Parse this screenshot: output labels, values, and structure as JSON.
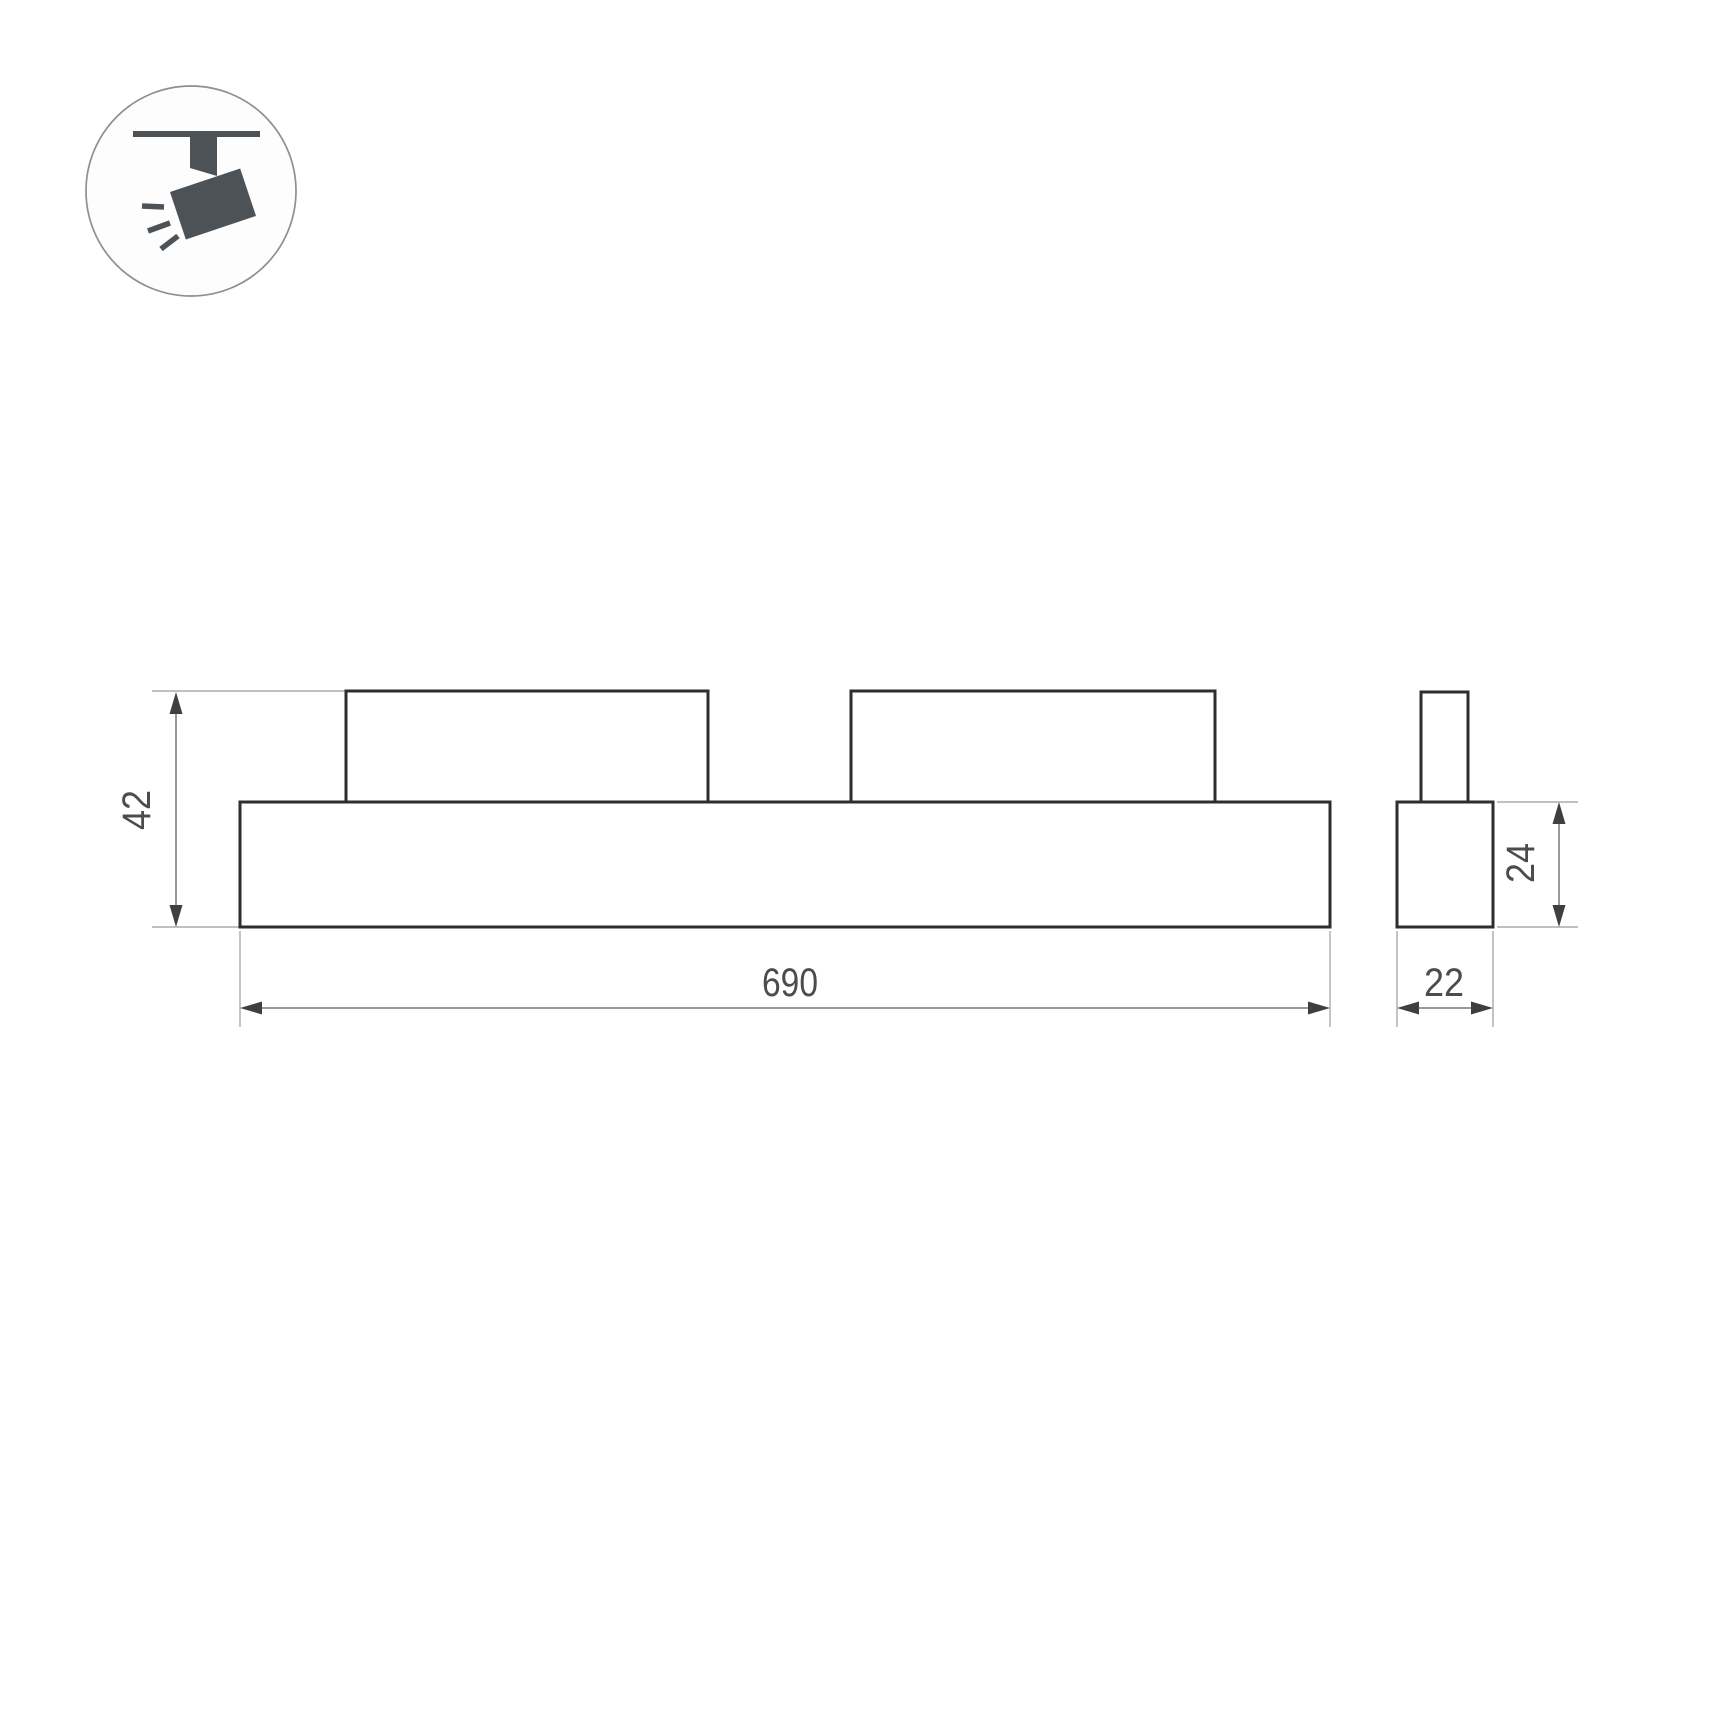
{
  "drawing": {
    "title": "track-mounted linear luminaire dimension drawing",
    "views": {
      "front": "front view with two top mounting modules",
      "side": "side profile with top connector stem"
    }
  },
  "dimensions": {
    "total_height": "42",
    "length": "690",
    "side_height": "24",
    "side_width": "22"
  },
  "icon": {
    "name": "track-spotlight-icon",
    "meaning": "ceiling track with tilted spotlight emitting light"
  },
  "colors": {
    "bg": "#ffffff",
    "outline": "#2c2e30",
    "thin": "#a9abad",
    "dim": "#77797b",
    "arrow": "#3c4043",
    "text": "#4a4d4f",
    "icon": "#4d5257",
    "circle": "#8d8f91"
  }
}
